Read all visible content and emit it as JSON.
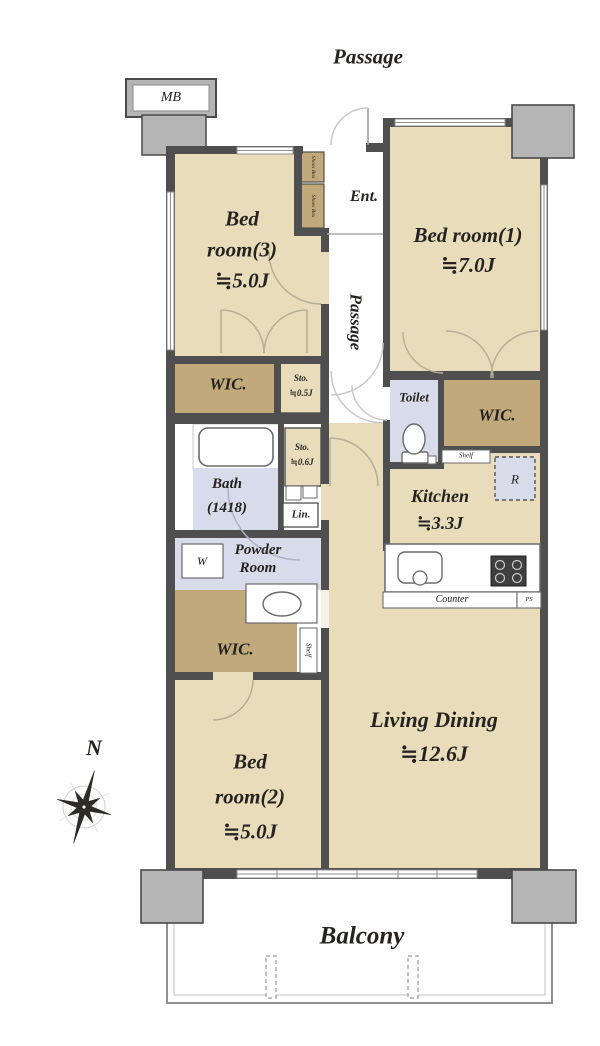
{
  "plan": {
    "colors": {
      "room_fill": "#e8dcba",
      "closet_fill": "#c2a97c",
      "wet_area_fill": "#d8dcea",
      "pillar_fill": "#b5b5b5",
      "wall": "#4f4f4f"
    },
    "exterior": {
      "passage_top": "Passage",
      "meter_box": "MB",
      "balcony": "Balcony",
      "compass_north": "N"
    },
    "entrance": {
      "label": "Ent.",
      "passage_vertical": "Passage",
      "shoes_box_upper": "Shoes Box",
      "shoes_box_lower": "Shoes Box"
    },
    "bedroom1": {
      "line1": "Bed room(1)",
      "line2": "≒7.0J"
    },
    "bedroom2": {
      "line1": "Bed",
      "line2": "room(2)",
      "line3": "≒5.0J"
    },
    "bedroom3": {
      "line1": "Bed",
      "line2": "room(3)",
      "line3": "≒5.0J"
    },
    "living": {
      "line1": "Living Dining",
      "line2": "≒12.6J"
    },
    "kitchen": {
      "line1": "Kitchen",
      "line2": "≒3.3J",
      "counter": "Counter",
      "ps": "PS",
      "fridge": "R"
    },
    "storage": {
      "wic_left": "WIC.",
      "wic_right": "WIC.",
      "wic_bottom": "WIC.",
      "sto_05_line1": "Sto.",
      "sto_05_line2": "≒0.5J",
      "sto_06_line1": "Sto.",
      "sto_06_line2": "≒0.6J",
      "shelf_right": "Shelf",
      "shelf_bottom": "Shelf",
      "linen": "Lin."
    },
    "sanitary": {
      "toilet": "Toilet",
      "bath_line1": "Bath",
      "bath_line2": "(1418)",
      "powder_line1": "Powder",
      "powder_line2": "Room",
      "washer": "W"
    }
  }
}
